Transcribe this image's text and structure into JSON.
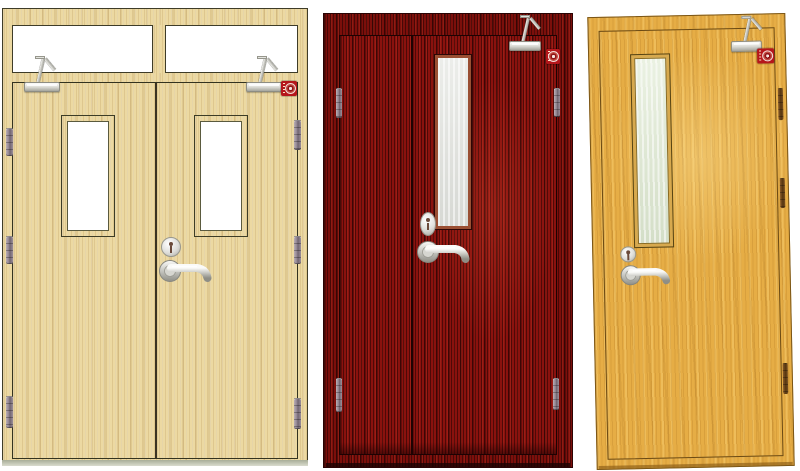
{
  "scene": {
    "background_color": "#ffffff"
  },
  "hardware_colors": {
    "lever_and_hinge_metal": "#c9c9c4",
    "door_closer_body": "#e9e9e4",
    "bronze_hinge": "#6a4420"
  },
  "fire_label": {
    "badge_color": "#b5161b",
    "emblem": "circular-certification-seal",
    "text_legible": false
  },
  "doors": [
    {
      "name": "double-leaf-fire-door-with-transom",
      "finish": "light-beech",
      "finish_color": "#ecd9a2",
      "outline_color": "#3e3c28",
      "glass_color": "#ffffff",
      "transom_panes": 2,
      "leaves": 2,
      "vision_panels": 2,
      "door_closers": 2,
      "hinges": 6,
      "escutcheons": 1,
      "lever_handles": 1,
      "fire_labels": 1
    },
    {
      "name": "leaf-and-a-half-fire-door",
      "finish": "red-mahogany",
      "finish_color": "#8a120e",
      "outline_color": "#2b0404",
      "glass_color": "#e2e4df",
      "transom_panes": 0,
      "leaves": 2,
      "vision_panels": 1,
      "door_closers": 1,
      "hinges": 4,
      "escutcheons": 1,
      "lever_handles": 1,
      "fire_labels": 1
    },
    {
      "name": "single-leaf-fire-door",
      "finish": "golden-oak",
      "finish_color": "#e6ad45",
      "outline_color": "#7a5517",
      "glass_color": "#dfead2",
      "transom_panes": 0,
      "leaves": 1,
      "vision_panels": 1,
      "door_closers": 1,
      "hinges": 3,
      "escutcheons": 1,
      "lever_handles": 1,
      "fire_labels": 1
    }
  ]
}
